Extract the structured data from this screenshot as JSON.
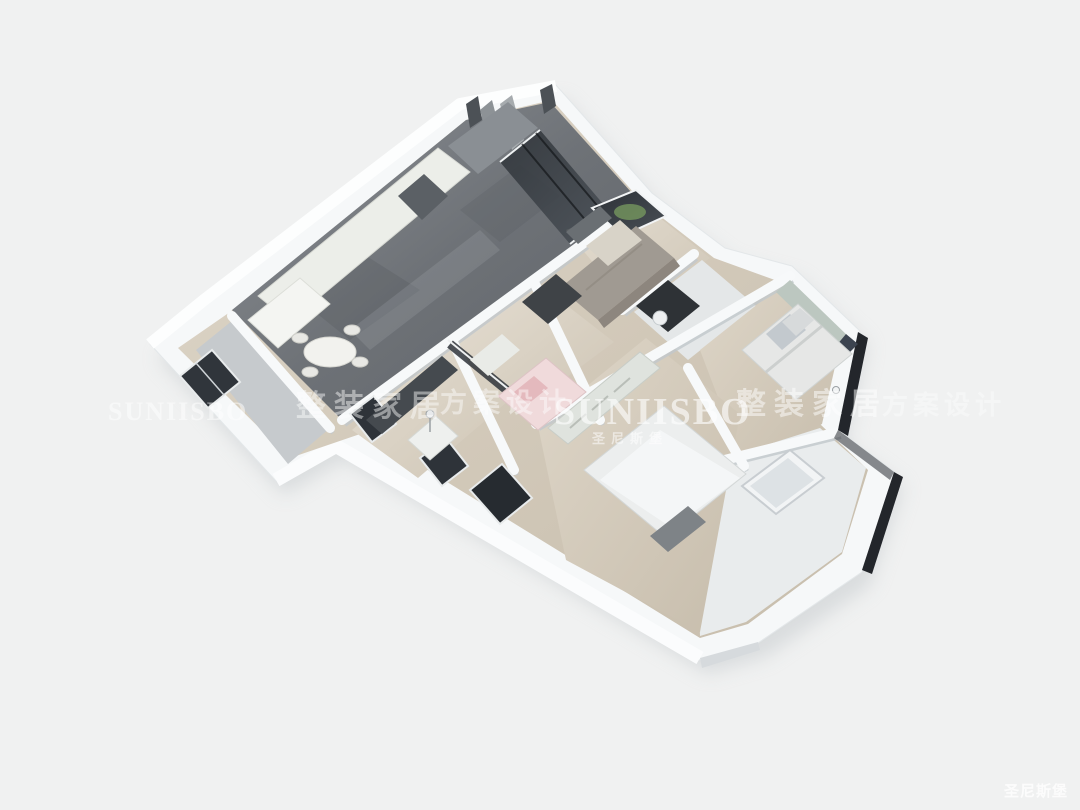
{
  "page": {
    "background": "#f0f1f1"
  },
  "watermarks": {
    "row": [
      {
        "text": "SUNIISBO"
      },
      {
        "text": "整装家居"
      },
      {
        "text": "方案设计"
      },
      {
        "text": "SUNIISBO",
        "subtext": "圣尼斯堡"
      },
      {
        "text": "整装家居"
      },
      {
        "text": "方案设计"
      }
    ],
    "corner": {
      "text": "圣尼斯堡"
    }
  },
  "palette": {
    "background": "#f0f1f1",
    "wall_top": "#f6f8f9",
    "wall_shade": "#d6dbde",
    "wall_dark_edge": "#23262b",
    "marble_floor": "#75797e",
    "wood_floor": "#d2c9ba",
    "glass": "#363b41",
    "greenery": "#72925d",
    "sofa": "#a09a92",
    "accent_pink": "#f0dadb",
    "accent_sage": "#bcc7c0",
    "watermark": "#ffffff"
  },
  "floorplan": {
    "rooms": [
      {
        "name": "living-dining-kitchen",
        "floor": "#75797e"
      },
      {
        "name": "entry-foyer",
        "floor": "#75797e"
      },
      {
        "name": "balcony",
        "floor": "#c6cacd"
      },
      {
        "name": "glass-study-room",
        "floor": "#d8d0c3"
      },
      {
        "name": "kids-bedroom",
        "floor": "#d8d0c3"
      },
      {
        "name": "bedroom",
        "floor": "#d2c9ba"
      },
      {
        "name": "window-study-room",
        "floor": "#d8d0c3"
      },
      {
        "name": "laundry-bathroom",
        "floor": "#e4e7e8"
      },
      {
        "name": "master-bedroom",
        "floor": "#d2c9ba"
      },
      {
        "name": "master-bathroom",
        "floor": "#e9eced"
      }
    ]
  }
}
